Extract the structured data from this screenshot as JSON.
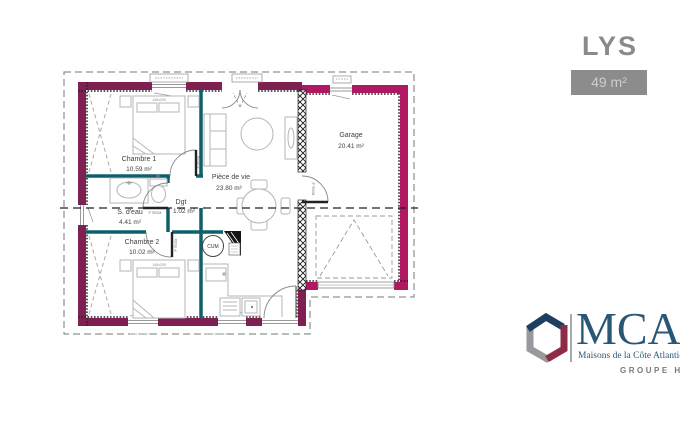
{
  "header": {
    "model_name": "LYS",
    "area_label": "49 m²"
  },
  "plan": {
    "rooms": [
      {
        "id": "chambre1",
        "name": "Chambre 1",
        "area": "10.59 m²"
      },
      {
        "id": "piece_de_vie",
        "name": "Pièce de vie",
        "area": "23.80 m²"
      },
      {
        "id": "garage",
        "name": "Garage",
        "area": "20.41 m²"
      },
      {
        "id": "sdeau",
        "name": "S. d'eau",
        "area": "4.41 m²"
      },
      {
        "id": "dgt",
        "name": "Dgt",
        "area": "1.02 m²"
      },
      {
        "id": "chambre2",
        "name": "Chambre 2",
        "area": "10.02 m²"
      }
    ],
    "annotations": {
      "water_heater": "CUM",
      "bed_size": "140x200",
      "door_size": "P 75/204"
    },
    "colors": {
      "exterior_wall": "#7e2152",
      "garage_wall": "#b01961",
      "partition": "#10606c"
    }
  },
  "logo": {
    "brand": "MCA",
    "tagline": "Maisons de la Côte Atlantique",
    "group": "GROUPE HEXAOM"
  }
}
